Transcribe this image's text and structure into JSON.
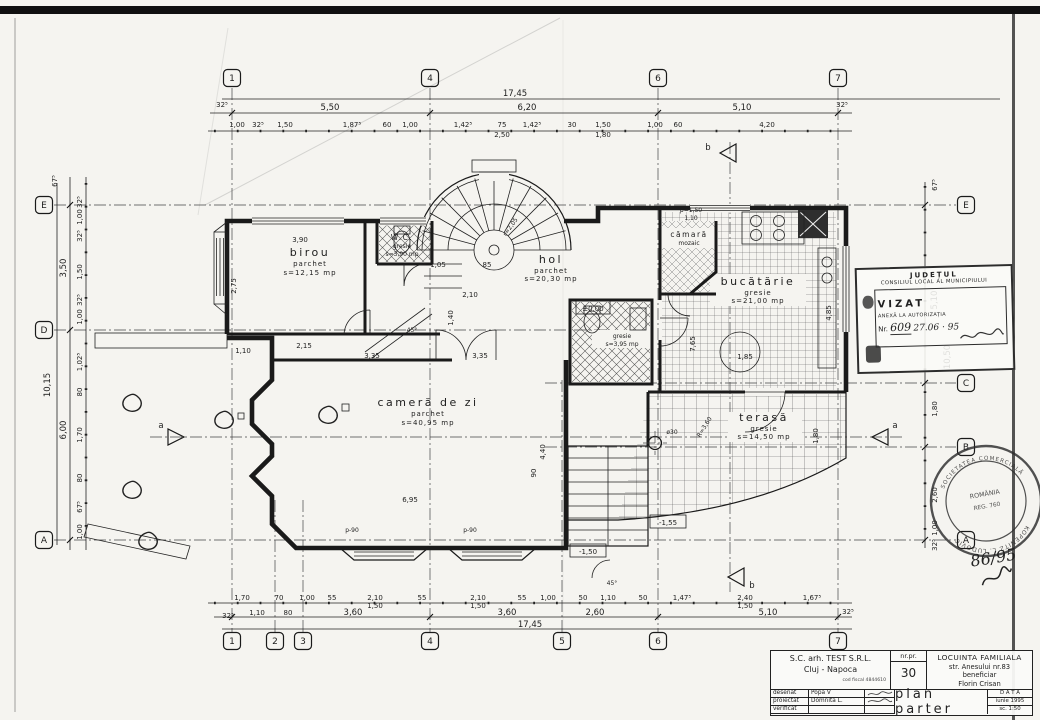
{
  "colors": {
    "paper": "#f5f4f0",
    "ink": "#1f1f1f"
  },
  "rooms": {
    "birou": {
      "name": "birou",
      "finish": "parchet",
      "area": "s=12,15 mp"
    },
    "wc": {
      "name": "W.C.",
      "finish": "gresie",
      "area": "s=3,90 mp"
    },
    "hol": {
      "name": "hol",
      "finish": "parchet",
      "area": "s=20,30 mp"
    },
    "camara": {
      "name": "cămară",
      "finish": "mozaic"
    },
    "bucatarie": {
      "name": "bucătărie",
      "finish": "gresie",
      "area": "s=21,00 mp"
    },
    "camera_de_zi": {
      "name": "cameră de zi",
      "finish": "parchet",
      "area": "s=40,95 mp"
    },
    "terasa": {
      "name": "terasă",
      "finish": "gresie",
      "area": "s=14,50 mp"
    },
    "baie": {
      "finish": "gresie",
      "area": "s=3,95 mp"
    }
  },
  "levels": {
    "zero": "±0.00",
    "m150": "-1,50",
    "m155": "-1,55"
  },
  "annotations": {
    "stair_radius": "r=2,05",
    "terrace_radius": "R=3,60",
    "column": "ø30",
    "angle": "45°",
    "parapet_high": "p=1,50",
    "parapet_high2": "1,10",
    "parapet_low1": "p-90",
    "parapet_low2": "p-90"
  },
  "grid": {
    "cols": [
      "1",
      "2",
      "3",
      "4",
      "5",
      "6",
      "7"
    ],
    "rows": {
      "A": "A",
      "B": "B",
      "C": "C",
      "D": "D",
      "E": "E"
    }
  },
  "sections": {
    "a": "a",
    "b": "b"
  },
  "dims": {
    "top_outer": "17,45",
    "top_mid": [
      "32⁵",
      "5,50",
      "6,20",
      "5,10",
      "32⁵"
    ],
    "top_detail": [
      "1,00",
      "32⁵",
      "1,50",
      "1,87⁵",
      "60",
      "1,00",
      "1,42⁵",
      "75",
      "2,50",
      "1,42⁵",
      "30",
      "1,50",
      "1,80",
      "1,00",
      "60",
      "4,20"
    ],
    "bottom_outer": "17,45",
    "bottom_mid": [
      "32⁵",
      "1,10",
      "80",
      "3,60",
      "3,60",
      "2,60",
      "5,10",
      "32⁵"
    ],
    "bottom_detail": [
      "1,70",
      "70",
      "1,00",
      "55",
      "2,10",
      "1,50",
      "55",
      "2,10",
      "1,50",
      "55",
      "1,00",
      "50",
      "1,10",
      "50",
      "1,47⁵",
      "2,40",
      "1,50",
      "1,67⁵"
    ],
    "left_outer": "10,15",
    "left_top": "67⁵",
    "left_mid": [
      "3,50",
      "6,00"
    ],
    "left_detail": [
      "32⁵",
      "1,00",
      "32⁵",
      "1,50",
      "32⁵",
      "1,00",
      "1,02⁵",
      "80",
      "1,70",
      "80",
      "67⁵",
      "1,00"
    ],
    "right_outer": "10,50",
    "right_mid": [
      "67⁵",
      "5,10",
      "1,80",
      "2,60",
      "1,00",
      "32⁵"
    ],
    "interior": [
      "3,90",
      "2,75",
      "1,05",
      "2,15",
      "3,35",
      "3,35",
      "1,40",
      "4,40",
      "6,95",
      "7,65",
      "4,85",
      "1,85",
      "2,10",
      "1,80",
      "90",
      "1,10",
      "85"
    ]
  },
  "municipal_stamp": {
    "header1": "JUDEȚUL",
    "header2": "CONSILIUL LOCAL AL MUNICIPIULUI",
    "vizat": "VIZAT",
    "anexa": "ANEXĂ LA AUTORIZAȚIA",
    "nr_label": "Nr.",
    "nr_value": "609",
    "date": "27.06 · 95"
  },
  "round_stamp": {
    "arc_top": "SOCIETATEA COMERCIALĂ",
    "arc_bottom": "KOPENITZ L. LUDOVIC",
    "center1": "ROMÂNIA",
    "center2": "REG. 760"
  },
  "note": "86/95",
  "title_block": {
    "firm": "S.C. arh. TEST S.R.L.",
    "city": "Cluj - Napoca",
    "fiscal": "cod fiscal 4844610",
    "nr_label": "nr.pr.",
    "nr_value": "30",
    "project": "LOCUINTA FAMILIALA",
    "address": "str. Anesului nr.83",
    "beneficiary_label": "beneficiar",
    "beneficiary": "Florin Crisan",
    "rows": [
      {
        "role": "desenat",
        "name": "Popa V"
      },
      {
        "role": "proiectat",
        "name": "Domnita L."
      },
      {
        "role": "verificat",
        "name": ""
      }
    ],
    "drawing_title": "plan parter",
    "date_label": "D A T A",
    "date": "iunie 1995",
    "scale": "sc. 1:50"
  }
}
